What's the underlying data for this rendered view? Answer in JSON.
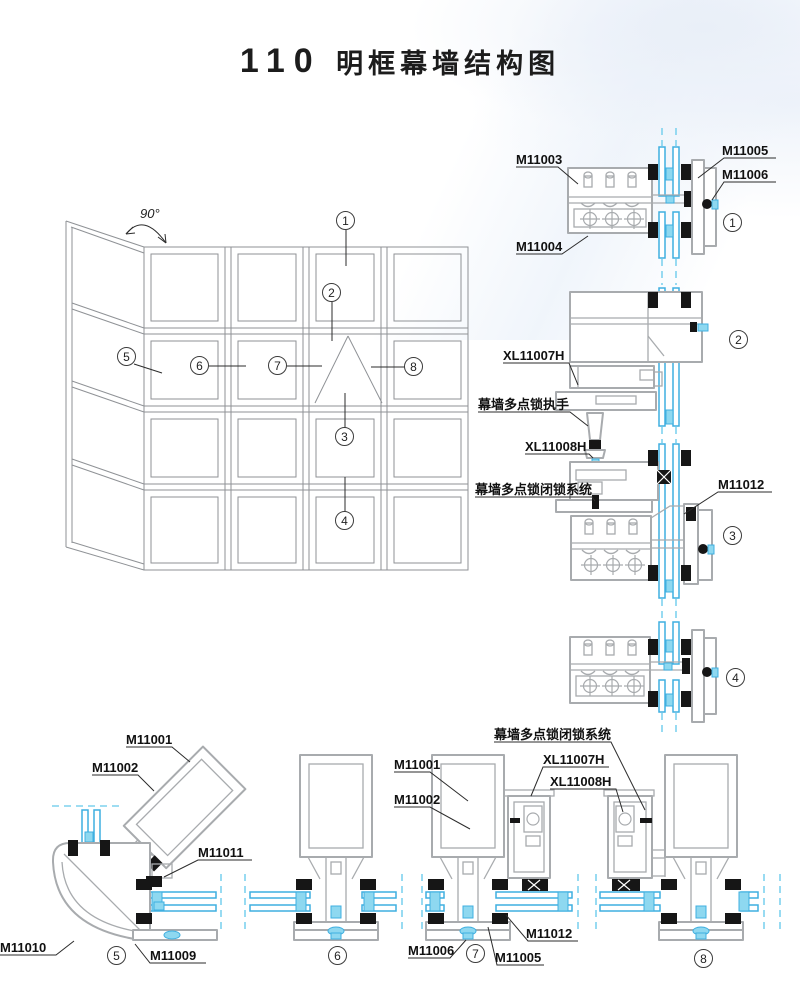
{
  "title": {
    "code": "110",
    "name": "明框幕墙结构图"
  },
  "elevation": {
    "angle": "90°"
  },
  "callouts": {
    "n1": "1",
    "n2": "2",
    "n3": "3",
    "n4": "4",
    "n5": "5",
    "n6": "6",
    "n7": "7",
    "n8": "8"
  },
  "labels": {
    "m11001": "M11001",
    "m11002": "M11002",
    "m11003": "M11003",
    "m11004": "M11004",
    "m11005": "M11005",
    "m11006": "M11006",
    "m11009": "M11009",
    "m11010": "M11010",
    "m11011": "M11011",
    "m11012": "M11012",
    "xl11007h": "XL11007H",
    "xl11008h": "XL11008H",
    "lock_handle": "幕墙多点锁执手",
    "lock_system": "幕墙多点锁闭锁系统"
  },
  "colors": {
    "glass": "#3fafe0",
    "glass_light": "#8ed8f0",
    "profile": "#a8abae",
    "gasket": "#161616",
    "line": "#8f9296"
  }
}
